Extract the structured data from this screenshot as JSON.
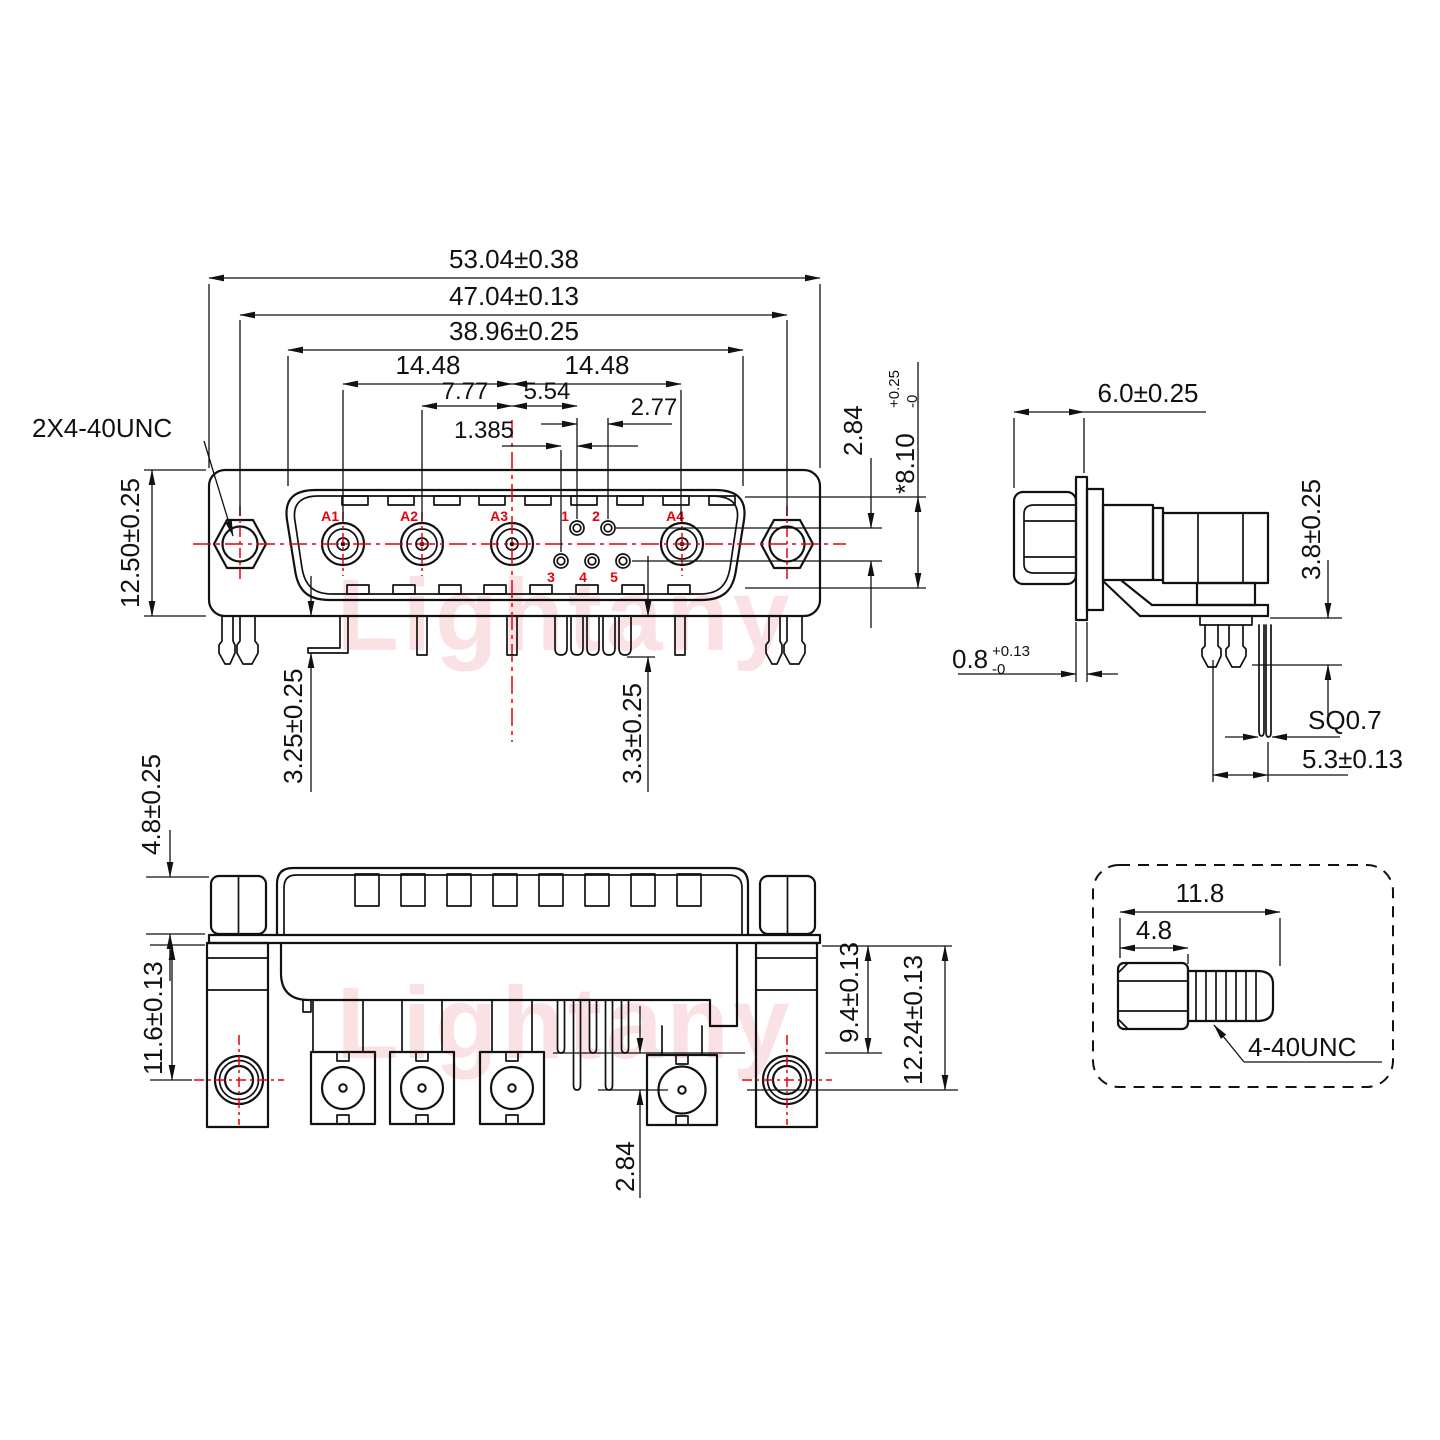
{
  "watermark": {
    "text": "Lightany",
    "color": "#f6c9cd"
  },
  "front": {
    "screw_thread_note": "2X4-40UNC",
    "dim_overall_width": "53.04±0.38",
    "dim_screw_span": "47.04±0.13",
    "dim_flange_width": "38.96±0.25",
    "dim_pitch_left": "14.48",
    "dim_pitch_right": "14.48",
    "dim_a2_to_center": "7.77",
    "dim_center_to_pin": "5.54",
    "dim_pin_pitch": "2.77",
    "dim_row_stagger": "1.385",
    "dim_body_height": "12.50±0.25",
    "dim_pin_row_gap": "2.84",
    "dim_shell": {
      "value": "*8.10",
      "tol_plus": "+0.25",
      "tol_minus": "-0"
    },
    "dim_tail_left": "3.25±0.25",
    "dim_tail_right": "3.3±0.25",
    "contacts": [
      "A1",
      "A2",
      "A3",
      "A4"
    ],
    "pins": [
      "1",
      "2",
      "3",
      "4",
      "5"
    ]
  },
  "side": {
    "dim_shell_depth": "6.0±0.25",
    "dim_bracket_gap": "3.8±0.25",
    "dim_flange_thk": {
      "value": "0.8",
      "tol_plus": "+0.13",
      "tol_minus": "-0"
    },
    "dim_pin_square": "SQ0.7",
    "dim_pin_offset": "5.3±0.13"
  },
  "bottom": {
    "dim_nut_height": "4.8±0.25",
    "dim_mount_hole": "11.6±0.13",
    "dim_pin_depth": "9.4±0.13",
    "dim_coax_depth": "12.24±0.13",
    "dim_row_gap": "2.84"
  },
  "screw": {
    "dim_overall": "11.8",
    "dim_head": "4.8",
    "thread": "4-40UNC"
  }
}
